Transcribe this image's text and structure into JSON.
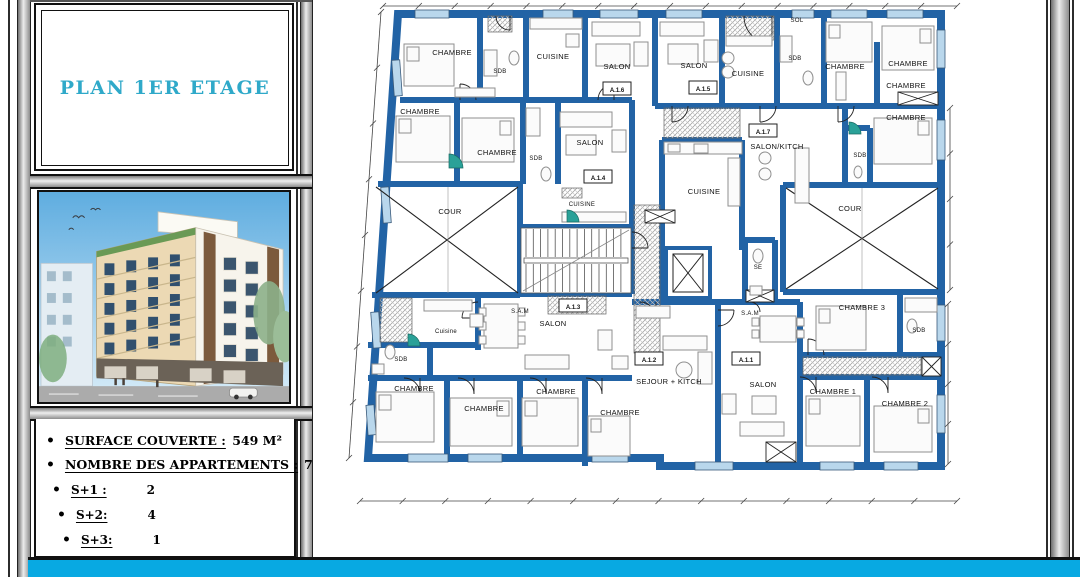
{
  "title_panel": {
    "title": "PLAN 1ER ETAGE"
  },
  "info": {
    "rows": [
      {
        "label": "SURFACE COUVERTE :",
        "value": "549 M²"
      },
      {
        "label": "NOMBRE DES APPARTEMENTS :",
        "value": "7"
      },
      {
        "label": "S+1 :",
        "value": "2"
      },
      {
        "label": "S+2:",
        "value": "4"
      },
      {
        "label": "S+3:",
        "value": "1"
      }
    ]
  },
  "plan": {
    "rooms": [
      {
        "label": "CHAMBRE",
        "x": 452,
        "y": 55
      },
      {
        "label": "SDB",
        "x": 500,
        "y": 73,
        "small": true
      },
      {
        "label": "CUISINE",
        "x": 553,
        "y": 59
      },
      {
        "label": "SALON",
        "x": 617,
        "y": 69
      },
      {
        "label": "SALON",
        "x": 694,
        "y": 68
      },
      {
        "label": "CUISINE",
        "x": 748,
        "y": 76
      },
      {
        "label": "SOL",
        "x": 797,
        "y": 22,
        "small": true
      },
      {
        "label": "SDB",
        "x": 795,
        "y": 60,
        "small": true
      },
      {
        "label": "CHAMBRE",
        "x": 845,
        "y": 69
      },
      {
        "label": "CHAMBRE",
        "x": 908,
        "y": 66
      },
      {
        "label": "CHAMBRE",
        "x": 906,
        "y": 88
      },
      {
        "label": "CHAMBRE",
        "x": 906,
        "y": 120
      },
      {
        "label": "CHAMBRE",
        "x": 420,
        "y": 114
      },
      {
        "label": "CHAMBRE",
        "x": 497,
        "y": 155
      },
      {
        "label": "SDB",
        "x": 536,
        "y": 160,
        "small": true
      },
      {
        "label": "SALON",
        "x": 590,
        "y": 145
      },
      {
        "label": "SALON/KITCH",
        "x": 777,
        "y": 149
      },
      {
        "label": "SDB",
        "x": 860,
        "y": 157,
        "small": true
      },
      {
        "label": "CUISINE",
        "x": 704,
        "y": 194
      },
      {
        "label": "CUISINE",
        "x": 582,
        "y": 206,
        "small": true
      },
      {
        "label": "COUR",
        "x": 450,
        "y": 214
      },
      {
        "label": "COUR",
        "x": 850,
        "y": 211
      },
      {
        "label": "SE",
        "x": 758,
        "y": 269,
        "small": true
      },
      {
        "label": "S.A.M",
        "x": 520,
        "y": 313,
        "small": true
      },
      {
        "label": "SALON",
        "x": 553,
        "y": 326
      },
      {
        "label": "Cuisine",
        "x": 446,
        "y": 333,
        "small": true
      },
      {
        "label": "SDB",
        "x": 401,
        "y": 361,
        "small": true
      },
      {
        "label": "CHAMBRE",
        "x": 414,
        "y": 391
      },
      {
        "label": "CHAMBRE",
        "x": 484,
        "y": 411
      },
      {
        "label": "CHAMBRE",
        "x": 556,
        "y": 394
      },
      {
        "label": "CHAMBRE",
        "x": 620,
        "y": 415
      },
      {
        "label": "S.A.M",
        "x": 750,
        "y": 315,
        "small": true
      },
      {
        "label": "SEJOUR + KITCH",
        "x": 669,
        "y": 384
      },
      {
        "label": "SALON",
        "x": 763,
        "y": 387
      },
      {
        "label": "CHAMBRE 3",
        "x": 862,
        "y": 310
      },
      {
        "label": "SDB",
        "x": 919,
        "y": 332,
        "small": true
      },
      {
        "label": "CHAMBRE 1",
        "x": 833,
        "y": 394
      },
      {
        "label": "CHAMBRE 2",
        "x": 905,
        "y": 406
      }
    ],
    "apartments": [
      {
        "label": "A.1.6",
        "x": 617,
        "y": 90
      },
      {
        "label": "A.1.5",
        "x": 703,
        "y": 89
      },
      {
        "label": "A.1.7",
        "x": 763,
        "y": 132
      },
      {
        "label": "A.1.4",
        "x": 598,
        "y": 178
      },
      {
        "label": "A.1.3",
        "x": 573,
        "y": 307
      },
      {
        "label": "A.1.2",
        "x": 649,
        "y": 360
      },
      {
        "label": "A.1.1",
        "x": 746,
        "y": 360
      }
    ]
  },
  "colors": {
    "wall_blue": "#2263a5",
    "window_blue": "#b9d7ec",
    "footer_cyan": "#08a9e2",
    "title_teal": "#2fa9c9"
  }
}
